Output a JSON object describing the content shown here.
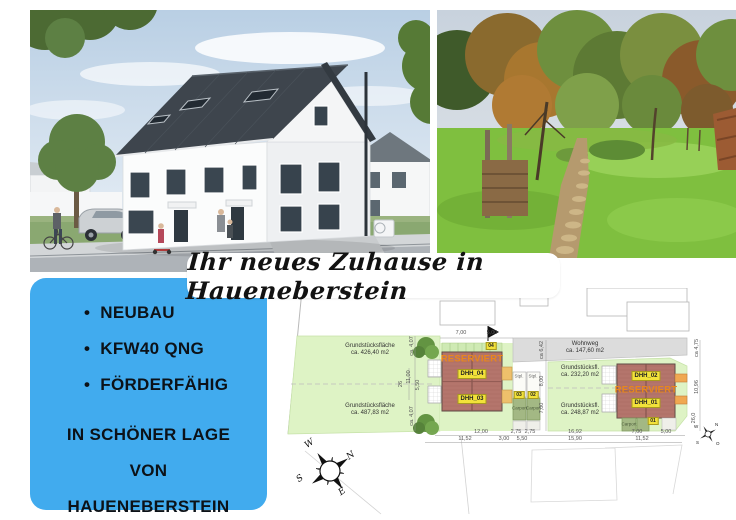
{
  "banner": {
    "title": "Ihr neues Zuhause in Haueneberstein"
  },
  "features": {
    "bullets": [
      "NEUBAU",
      "KFW40 QNG",
      "FÖRDERFÄHIG"
    ],
    "location_lines": [
      "IN SCHÖNER LAGE",
      "VON",
      "HAUENEBERSTEIN"
    ]
  },
  "colors": {
    "accent_cyan": "#41abee",
    "reserved_orange": "#e8871c",
    "plan_green": "#def3c5",
    "building_red": "#b4756c",
    "label_yellow": "#f2e23a"
  },
  "site_plan": {
    "reserved_label": "RESERVIERT",
    "houses": [
      "DHH_04",
      "DHH_03",
      "DHH_02",
      "DHH_01"
    ],
    "plots": [
      {
        "line1": "Grundstücksfläche",
        "line2": "ca. 426,40 m2"
      },
      {
        "line1": "Grundstücksfläche",
        "line2": "ca. 487,83 m2"
      },
      {
        "line1": "Grundstücksfl.",
        "line2": "ca. 232,20 m2"
      },
      {
        "line1": "Grundstücksfl.",
        "line2": "ca. 248,87 m2"
      }
    ],
    "wohnweg": {
      "line1": "Wohnweg",
      "line2": "ca. 147,60 m2"
    },
    "carport_label": "Carport",
    "stall_label": "Stpl.",
    "stall_numbers": [
      "04",
      "03",
      "02",
      "01"
    ],
    "dims_top": [
      "7,00",
      "5,00"
    ],
    "dims_left": [
      "ca. 4,07",
      "11,00",
      "5,50",
      "26",
      "ca. 4,07"
    ],
    "dims_mid": [
      "ca 6,42",
      "8,00",
      "7,00"
    ],
    "dims_right": [
      "ca 4,75",
      "10,96",
      "26,0"
    ],
    "dims_row1": [
      "12,00",
      "2,75",
      "2,75",
      "16,92",
      "7,00",
      "5,00"
    ],
    "dims_row2": [
      "11,52",
      "3,00",
      "5,50",
      "15,90",
      "11,52"
    ],
    "compass_main": [
      "W",
      "N",
      "S",
      "E"
    ],
    "compass_small": [
      "W",
      "N",
      "S",
      "O"
    ]
  }
}
